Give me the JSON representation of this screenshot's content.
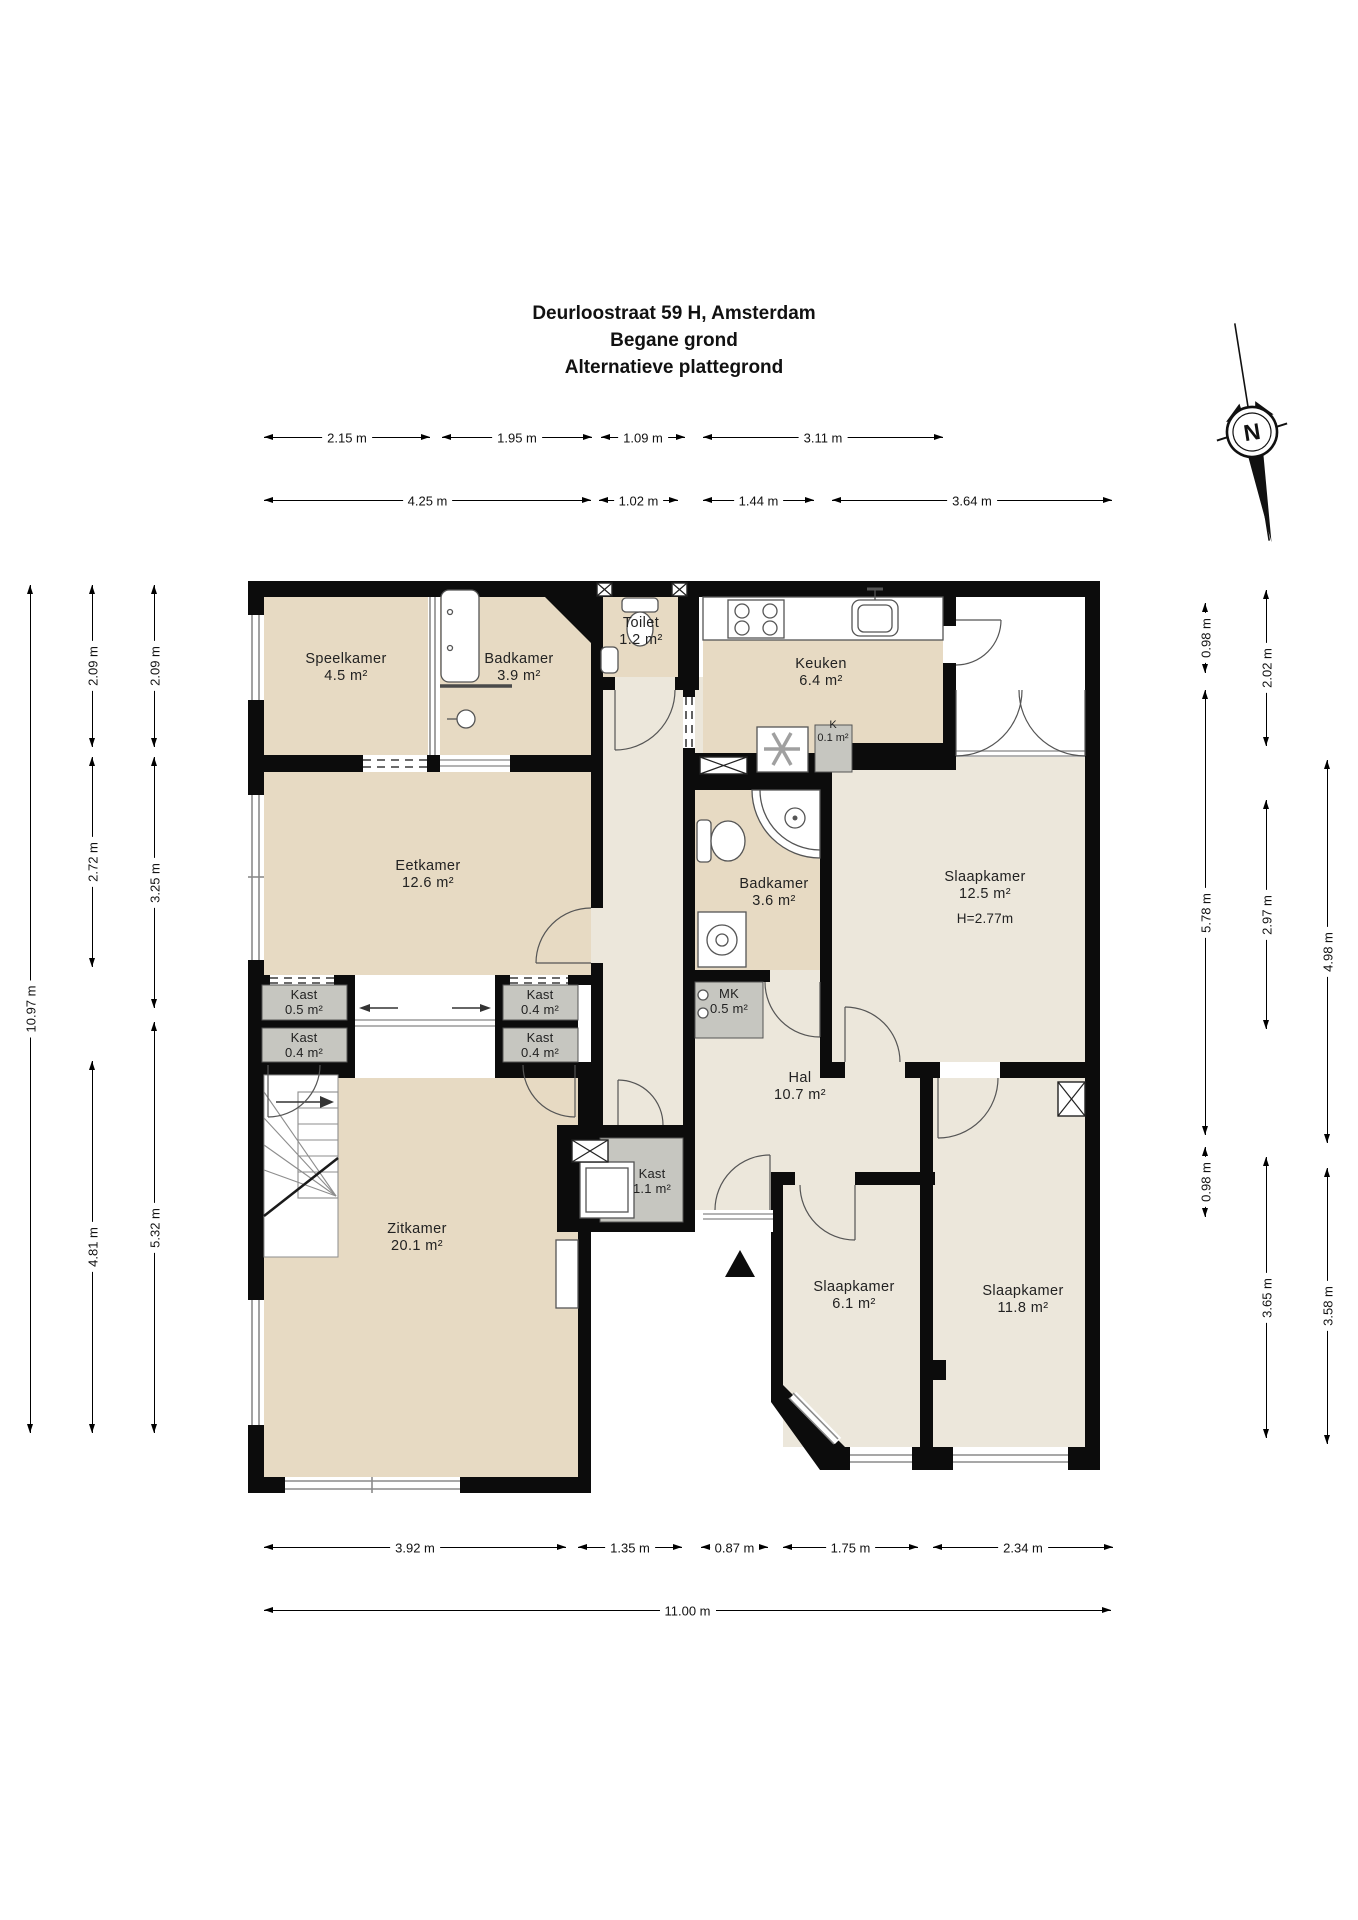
{
  "title": {
    "line1": "Deurloostraat 59 H, Amsterdam",
    "line2": "Begane grond",
    "line3": "Alternatieve plattegrond"
  },
  "compass": {
    "north_label": "N"
  },
  "rooms": {
    "speelkamer": {
      "name": "Speelkamer",
      "area": "4.5 m²"
    },
    "badkamer_boven": {
      "name": "Badkamer",
      "area": "3.9 m²"
    },
    "toilet": {
      "name": "Toilet",
      "area": "1.2 m²"
    },
    "keuken": {
      "name": "Keuken",
      "area": "6.4 m²"
    },
    "kast_k": {
      "name": "K",
      "area": "0.1 m²"
    },
    "eetkamer": {
      "name": "Eetkamer",
      "area": "12.6 m²"
    },
    "badkamer": {
      "name": "Badkamer",
      "area": "3.6 m²"
    },
    "slaapkamer_1": {
      "name": "Slaapkamer",
      "area": "12.5 m²",
      "height": "H=2.77m"
    },
    "mk": {
      "name": "MK",
      "area": "0.5 m²"
    },
    "hal": {
      "name": "Hal",
      "area": "10.7 m²"
    },
    "kast_links_boven": {
      "name": "Kast",
      "area": "0.5 m²"
    },
    "kast_links_onder": {
      "name": "Kast",
      "area": "0.4 m²"
    },
    "kast_rechts_boven": {
      "name": "Kast",
      "area": "0.4 m²"
    },
    "kast_rechts_onder": {
      "name": "Kast",
      "area": "0.4 m²"
    },
    "kast_hal": {
      "name": "Kast",
      "area": "1.1 m²"
    },
    "zitkamer": {
      "name": "Zitkamer",
      "area": "20.1 m²"
    },
    "slaapkamer_2": {
      "name": "Slaapkamer",
      "area": "6.1 m²"
    },
    "slaapkamer_3": {
      "name": "Slaapkamer",
      "area": "11.8 m²"
    }
  },
  "dimensions": {
    "top_row_1": [
      "2.15 m",
      "1.95 m",
      "1.09 m",
      "3.11 m"
    ],
    "top_row_2": [
      "4.25 m",
      "1.02 m",
      "1.44 m",
      "3.64 m"
    ],
    "bottom_row_1": [
      "3.92 m",
      "1.35 m",
      "0.87 m",
      "1.75 m",
      "2.34 m"
    ],
    "bottom_row_2": [
      "11.00 m"
    ],
    "left_total": [
      "10.97 m"
    ],
    "left_col_a": [
      "2.09 m",
      "2.72 m",
      "4.81 m"
    ],
    "left_col_b": [
      "2.09 m",
      "3.25 m",
      "5.32 m"
    ],
    "right_col_a": [
      "0.98 m",
      "5.78 m",
      "0.98 m"
    ],
    "right_col_b": [
      "2.02 m",
      "2.97 m",
      "3.65 m"
    ],
    "right_col_c": [
      "4.98 m",
      "3.58 m"
    ]
  },
  "colors": {
    "wall": "#0c0c0c",
    "tan": "#e7dac3",
    "light": "#ece7db",
    "gray": "#c6c6c0"
  }
}
